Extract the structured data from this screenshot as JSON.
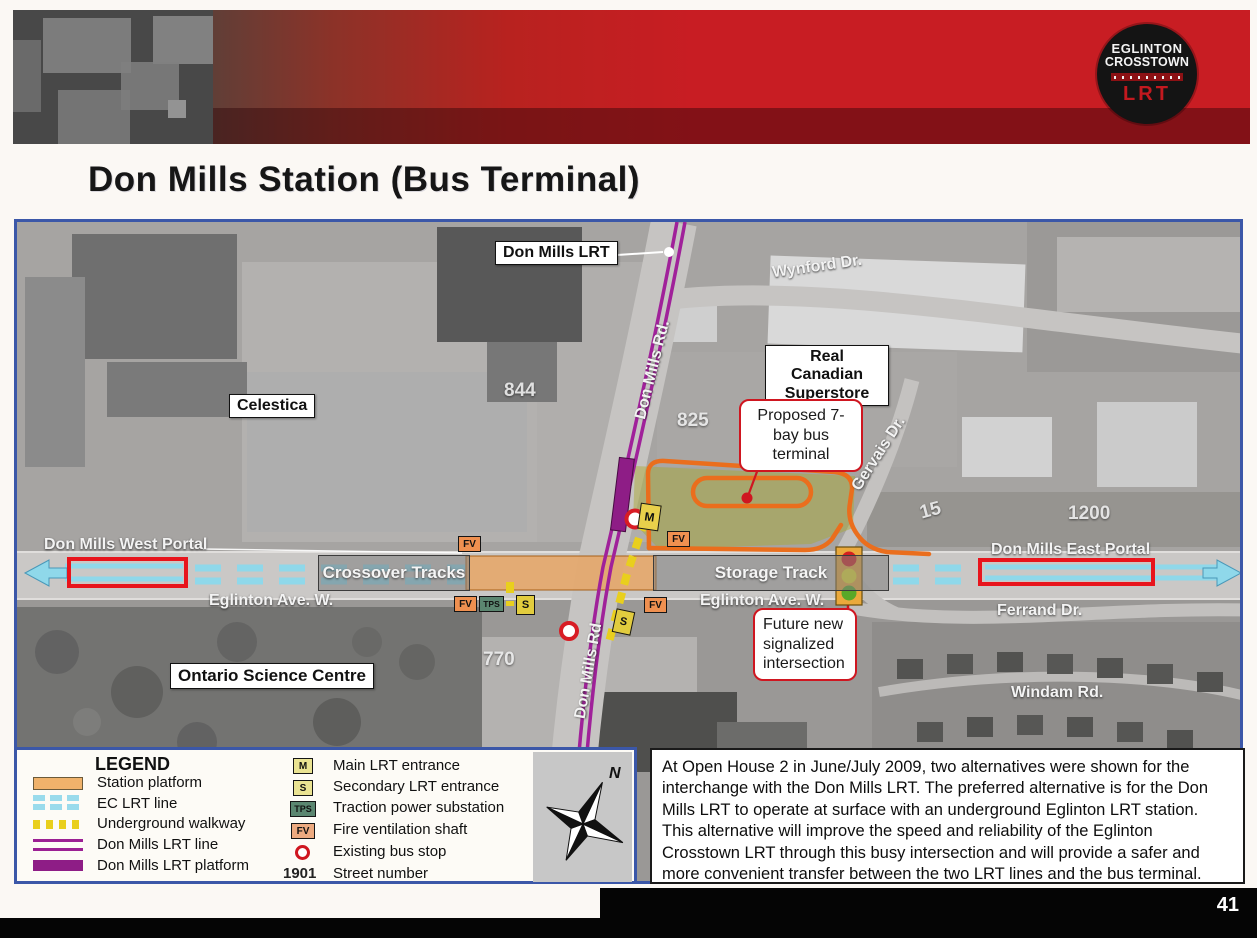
{
  "title": "Don Mills Station (Bus Terminal)",
  "logo": {
    "line1": "EGLINTON",
    "line2": "CROSSTOWN",
    "line3": "LRT"
  },
  "page_number": "41",
  "map": {
    "boxed_labels": {
      "don_mills_lrt": "Don Mills LRT",
      "celestica": "Celestica",
      "superstore": "Real Canadian Superstore",
      "science_centre": "Ontario Science Centre"
    },
    "callouts": {
      "bus_terminal": "Proposed 7-bay bus terminal",
      "intersection": "Future new signalized intersection"
    },
    "track_labels": {
      "crossover": "Crossover Tracks",
      "storage": "Storage Track"
    },
    "streets": {
      "wynford": "Wynford Dr.",
      "don_mills_rd_north": "Don Mills Rd.",
      "don_mills_rd_south": "Don Mills Rd",
      "gervais": "Gervais Dr.",
      "ferrand": "Ferrand Dr.",
      "windam": "Windam Rd.",
      "eglinton_west": "Eglinton Ave. W.",
      "eglinton_east": "Eglinton Ave. W.",
      "west_portal": "Don Mills West Portal",
      "east_portal": "Don Mills East Portal"
    },
    "street_numbers": {
      "celestica": "844",
      "superstore_lot": "825",
      "gervais_bldg": "15",
      "east_bldg": "1200",
      "science_lot": "770"
    },
    "markers": {
      "main": "M",
      "secondary": "S",
      "tps": "TPS",
      "fv": "FV"
    }
  },
  "legend": {
    "title": "LEGEND",
    "swatch_items": [
      {
        "label": "Station platform"
      },
      {
        "label": "EC LRT line"
      },
      {
        "label": "Underground walkway"
      },
      {
        "label": "Don Mills LRT line"
      },
      {
        "label": "Don Mills LRT platform"
      }
    ],
    "marker_items": [
      {
        "symbol": "M",
        "label": "Main LRT entrance"
      },
      {
        "symbol": "S",
        "label": "Secondary LRT entrance"
      },
      {
        "symbol": "TPS",
        "label": "Traction power substation"
      },
      {
        "symbol": "FV",
        "label": "Fire ventilation shaft"
      },
      {
        "symbol": "",
        "label": "Existing bus stop"
      },
      {
        "symbol": "1901",
        "label": "Street number"
      }
    ],
    "compass_label": "N"
  },
  "description": "At Open House 2 in June/July 2009, two alternatives were shown for the interchange with the Don Mills LRT. The preferred alternative is for the Don Mills LRT to operate at surface with an underground Eglinton LRT station. This alternative will improve the speed and reliability of the Eglinton Crosstown LRT through this busy intersection and will provide a safer and more convenient transfer between the two LRT lines and the bus terminal.",
  "colors": {
    "accent_blue": "#3b57a8",
    "banner_red": "#c81d23",
    "purple_lrt": "#9c2094",
    "cyan_ec": "#9adbec",
    "platform_orange": "#f0b26b",
    "loop_orange": "#ea6e1d",
    "walkway_yellow": "#e9cf1d",
    "callout_red": "#cf1620"
  }
}
